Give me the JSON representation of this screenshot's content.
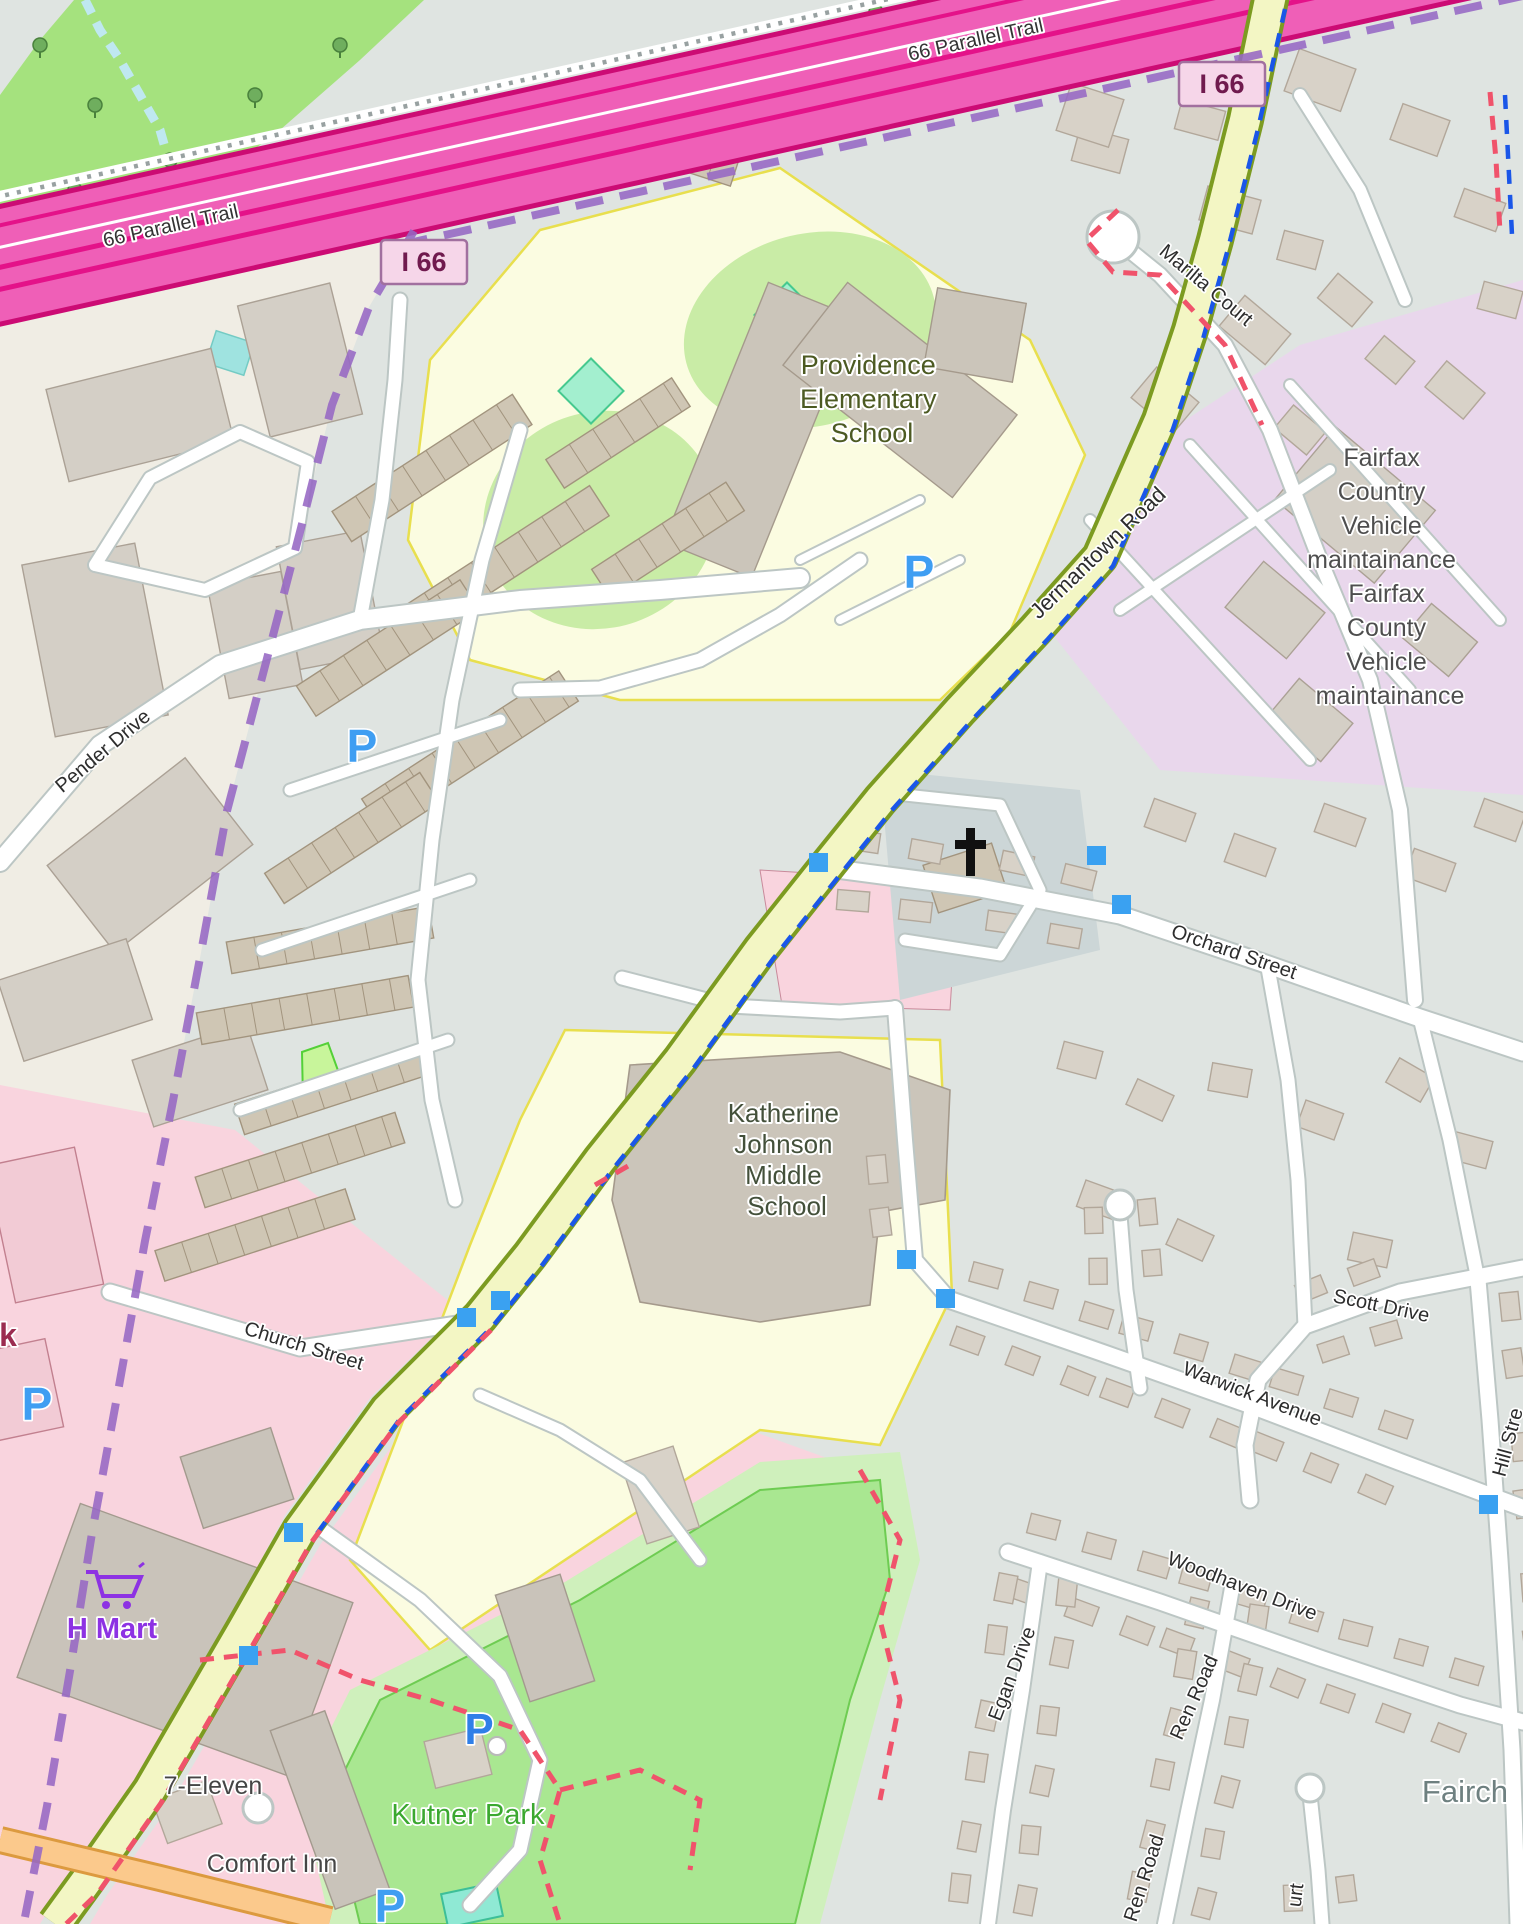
{
  "map_labels": {
    "trail": "66 Parallel Trail",
    "interstate_shield": "I 66",
    "providence_school": {
      "lines": [
        "Providence",
        "Elementary",
        "School"
      ]
    },
    "katherine_school": {
      "lines": [
        "Katherine",
        "Johnson",
        "Middle",
        "School"
      ]
    },
    "fairfax_maintenance": {
      "lines": [
        "Fairfax",
        "Country",
        "Vehicle",
        "maintainance",
        "Fairfax",
        "County",
        "Vehicle",
        "maintainance"
      ]
    },
    "streets": {
      "jermantown": "Jermantown Road",
      "marilta": "Marilta Court",
      "pender": "Pender Drive",
      "orchard": "Orchard Street",
      "church": "Church Street",
      "scott": "Scott Drive",
      "warwick": "Warwick Avenue",
      "woodhaven": "Woodhaven Drive",
      "hill_partial": "Hill Stre",
      "egan": "Egan Drive",
      "ren": "Ren Road",
      "court_partial": "urt"
    },
    "pois": {
      "hmart": "H Mart",
      "seven_eleven": "7-Eleven",
      "comfort_inn": "Comfort Inn",
      "kutner_park": "Kutner Park",
      "place_partial": "Fairch",
      "park_label_partial": "k",
      "parking_letter": "P"
    }
  },
  "icons": {
    "parking": "P-letter",
    "shopping_cart": "cart glyph",
    "church": "christian-cross glyph",
    "traffic_signal": "blue square"
  },
  "palette": {
    "motorway_fill": "#ef5fb7",
    "motorway_casing": "#cc0b74",
    "road_fill": "#f3f6c4",
    "road_casing": "#7c9b21",
    "school_area": "#fbfce1",
    "industrial_area": "#e9d7ec",
    "retail_area": "#f9d4de",
    "park_green": "#a9e791",
    "forest_green": "#a5e27e",
    "residential_bg": "#dfe4e1",
    "commercial_bg": "#f0ede4",
    "boundary_purple": "#9668c4",
    "cycle_route_blue": "#1a56e8",
    "path_red": "#f0536b",
    "marker_blue": "#3aa1f1"
  }
}
